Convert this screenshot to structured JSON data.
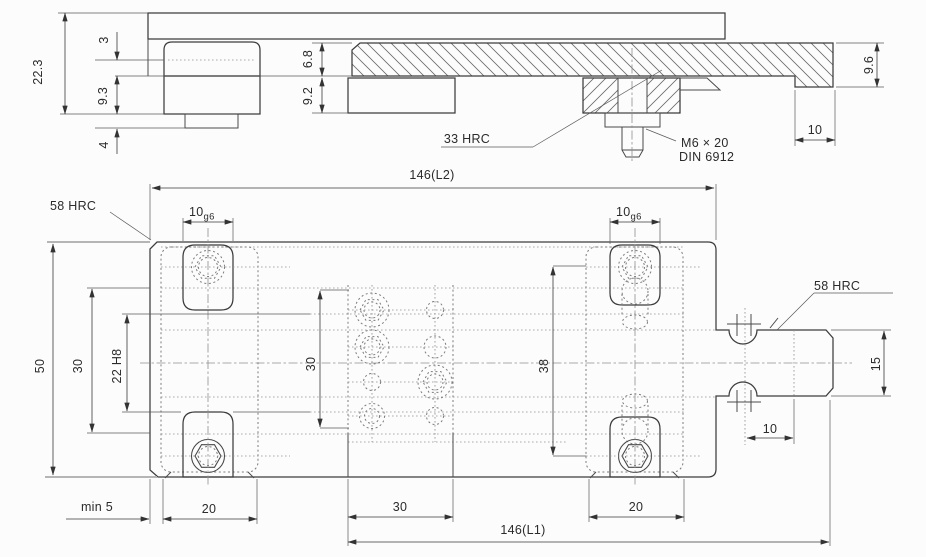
{
  "drawing": {
    "line_color": "#3c3c3c",
    "section_view": {
      "dims": {
        "total_height": "22.3",
        "gib_step": "3",
        "gib_depth": "9.3",
        "tab_height": "4",
        "rail_top": "6.8",
        "rail_bottom": "9.2",
        "end_height": "9.6",
        "end_offset": "10",
        "overall_length": "146(L2)"
      },
      "labels": {
        "hardness": "33 HRC",
        "screw": "M6 × 20",
        "screw_norm": "DIN 6912"
      }
    },
    "plan_view": {
      "dims": {
        "body_width": "50",
        "pocket_span": "30",
        "groove_width": "22 H8",
        "block_span": "30",
        "screw_span": "38",
        "tongue_width": "15",
        "tongue_inset": "10",
        "min_wall": "min 5",
        "slot_left_len": "20",
        "block_width": "30",
        "slot_right_len": "20",
        "overall_length": "146(L1)",
        "slot_fit_value": "10",
        "slot_fit_tol": "g6"
      },
      "labels": {
        "hardness_left": "58 HRC",
        "hardness_right": "58 HRC"
      }
    }
  }
}
